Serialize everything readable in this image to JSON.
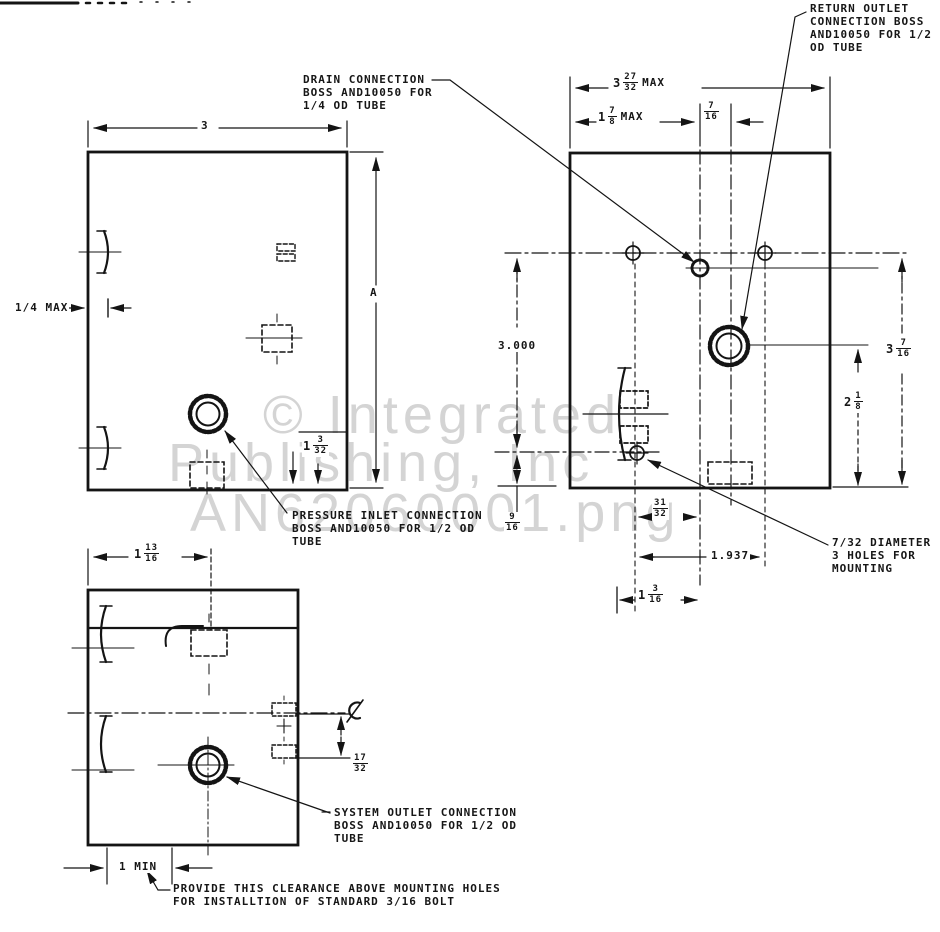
{
  "watermark": {
    "line1": "© Integrated",
    "line2": "Publishing, Inc",
    "line3": "AN62060001.png"
  },
  "notes": {
    "return_outlet": {
      "l1": "RETURN OUTLET",
      "l2": "CONNECTION BOSS",
      "l3": "AND10050 FOR 1/2",
      "l4": "OD TUBE"
    },
    "drain": {
      "l1": "DRAIN CONNECTION",
      "l2": "BOSS AND10050 FOR",
      "l3": "1/4 OD TUBE"
    },
    "pressure_inlet": {
      "l1": "PRESSURE INLET CONNECTION",
      "l2": "BOSS AND10050 FOR 1/2 OD",
      "l3": "TUBE"
    },
    "system_outlet": {
      "l1": "SYSTEM OUTLET CONNECTION",
      "l2": "BOSS AND10050 FOR 1/2 OD",
      "l3": "TUBE"
    },
    "mounting_holes": {
      "l1": "7/32 DIAMETER",
      "l2": "3 HOLES FOR",
      "l3": "MOUNTING"
    },
    "clearance": {
      "l1": "PROVIDE THIS CLEARANCE ABOVE MOUNTING HOLES",
      "l2": "FOR INSTALLTION OF STANDARD 3/16 BOLT"
    }
  },
  "dims": {
    "front_width": {
      "text": "3"
    },
    "front_height": {
      "text": "A"
    },
    "edge_offset": {
      "text": "1/4 MAX"
    },
    "inlet_height": {
      "whole": "1",
      "num": "3",
      "den": "32"
    },
    "side_width": {
      "whole": "1",
      "num": "13",
      "den": "16"
    },
    "outlet_drop": {
      "num": "17",
      "den": "32"
    },
    "clearance_min": {
      "text": "1 MIN"
    },
    "top_width": {
      "whole": "3",
      "num": "27",
      "den": "32",
      "suffix": "MAX"
    },
    "drain_offset": {
      "whole": "1",
      "num": "7",
      "den": "8",
      "suffix": "MAX"
    },
    "drain_to_return": {
      "num": "7",
      "den": "16"
    },
    "hole_span_v": {
      "text": "3.000"
    },
    "hole_to_bottom": {
      "num": "9",
      "den": "16"
    },
    "hole_to_drain": {
      "num": "31",
      "den": "32"
    },
    "hole_span_h": {
      "text": "1.937"
    },
    "boss_to_drain": {
      "whole": "1",
      "num": "3",
      "den": "16"
    },
    "top_height": {
      "whole": "3",
      "num": "7",
      "den": "16"
    },
    "return_to_bottom": {
      "whole": "2",
      "num": "1",
      "den": "8"
    }
  }
}
